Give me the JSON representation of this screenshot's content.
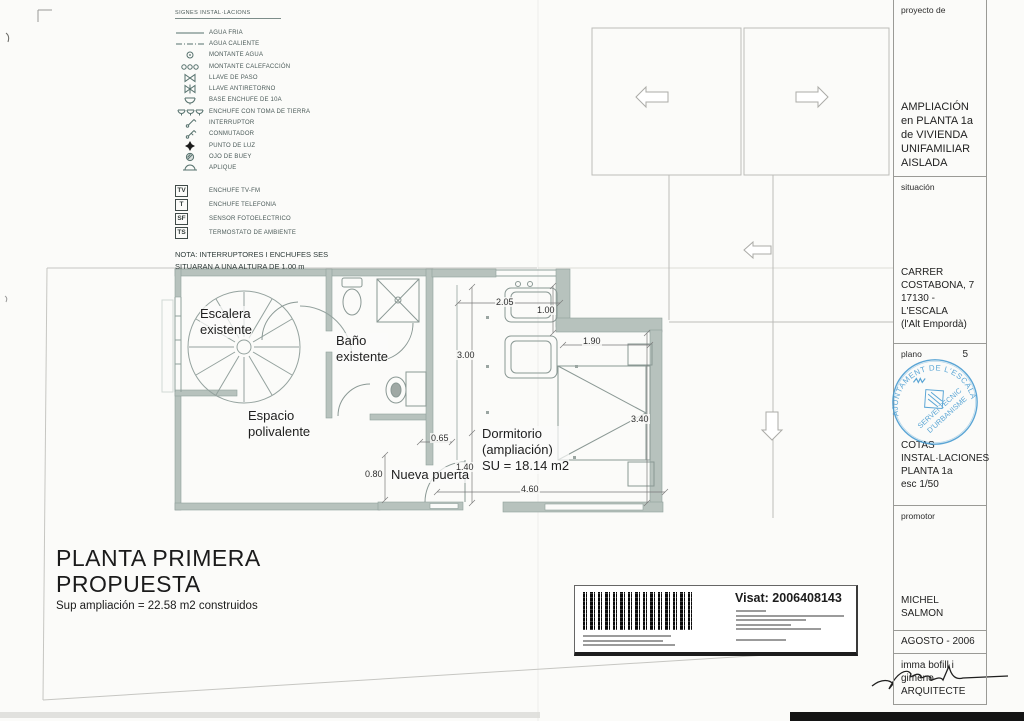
{
  "legend": {
    "title": "SIGNES INSTAL·LACIONS",
    "items": [
      {
        "icon": "agua-fria-line",
        "label": "AGUA FRIA"
      },
      {
        "icon": "agua-caliente-line",
        "label": "AGUA CALIENTE"
      },
      {
        "icon": "montante-agua",
        "label": "MONTANTE AGUA"
      },
      {
        "icon": "montante-calefaccion",
        "label": "MONTANTE CALEFACCIÓN"
      },
      {
        "icon": "llave-de-paso",
        "label": "LLAVE DE PASO"
      },
      {
        "icon": "llave-antiretorno",
        "label": "LLAVE ANTIRETORNO"
      },
      {
        "icon": "base-enchufe",
        "label": "BASE ENCHUFE DE 10A"
      },
      {
        "icon": "enchufe-toma-tierra",
        "label": "ENCHUFE CON TOMA DE TIERRA"
      },
      {
        "icon": "interruptor",
        "label": "INTERRUPTOR"
      },
      {
        "icon": "conmutador",
        "label": "CONMUTADOR"
      },
      {
        "icon": "punto-de-luz",
        "label": "PUNTO DE LUZ"
      },
      {
        "icon": "ojo-de-buey",
        "label": "OJO DE BUEY"
      },
      {
        "icon": "aplique",
        "label": "APLIQUE"
      }
    ],
    "boxed_items": [
      {
        "code": "TV",
        "label": "ENCHUFE TV-FM"
      },
      {
        "code": "T",
        "label": "ENCHUFE TELEFONIA"
      },
      {
        "code": "SF",
        "label": "SENSOR FOTOELECTRICO"
      },
      {
        "code": "TS",
        "label": "TERMOSTATO DE AMBIENTE"
      }
    ],
    "note": "NOTA: INTERRUPTORES I ENCHUFES SES\nSITUARAN A UNA ALTURA DE 1.00 m"
  },
  "plan": {
    "rooms": {
      "escalera": "Escalera\nexistente",
      "bano": "Baño\nexistente",
      "espacio": "Espacio\npolivalente",
      "dormitorio": "Dormitorio\n(ampliación)\nSU = 18.14 m2",
      "nueva_puerta": "Nueva puerta"
    },
    "dimensions": [
      "2.05",
      "1.00",
      "3.00",
      "1.90",
      "3.40",
      "0.65",
      "1.40",
      "0.80",
      "4.60"
    ]
  },
  "title": {
    "line1": "PLANTA PRIMERA",
    "line2": "PROPUESTA",
    "subtitle": "Sup ampliación = 22.58 m2 construidos"
  },
  "visa": {
    "label": "Visat: 2006408143"
  },
  "titleblock": {
    "project_label": "proyecto de",
    "project_name": "AMPLIACIÓN\nen PLANTA 1a\nde VIVIENDA\nUNIFAMILIAR\nAISLADA",
    "location_label": "situación",
    "location": "CARRER\nCOSTABONA, 7\n17130 - L'ESCALA\n(l'Alt Empordà)",
    "sheet_label": "plano",
    "sheet_number": "5",
    "sheet_title": "COTAS\nINSTAL·LACIONES\nPLANTA 1a\nesc 1/50",
    "promoter_label": "promotor",
    "promoter_name": "MICHEL SALMON",
    "date": "AGOSTO - 2006",
    "architect_name": "imma bofill i gimeno",
    "architect_title": "ARQUITECTE"
  },
  "stamp": {
    "arc_text": "AJUNTAMENT DE L'ESCALA",
    "line1": "SERVEI TÈCNIC",
    "line2": "D'URBANISME",
    "color": "#3f97cf"
  }
}
